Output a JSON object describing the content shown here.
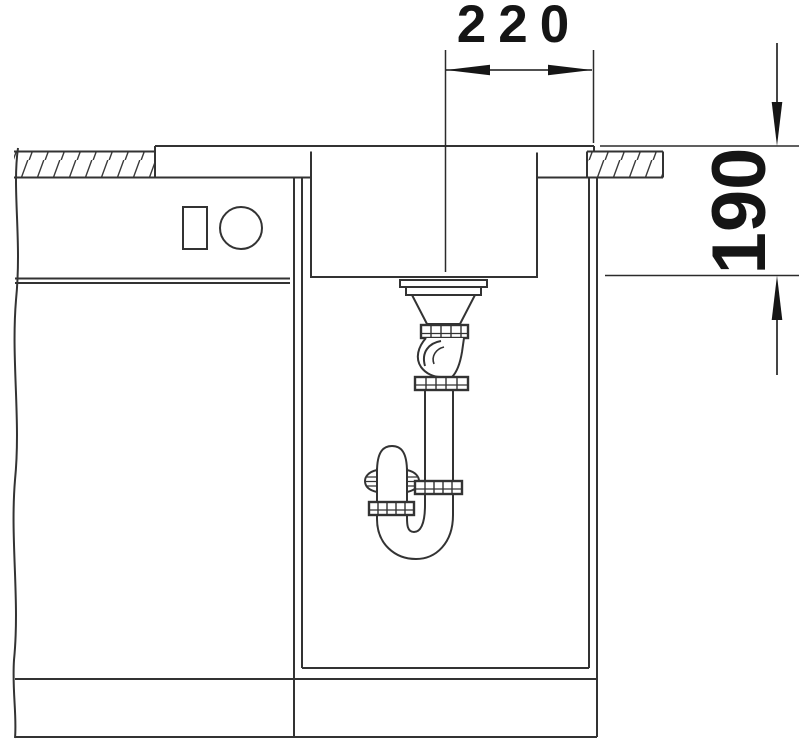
{
  "drawing": {
    "title": "Sink installation cross-section drawing",
    "dimensions": {
      "drain_to_edge": {
        "label": "220"
      },
      "installation_depth": {
        "label": "190"
      }
    },
    "colors": {
      "background": "#ffffff",
      "line": "#333333",
      "dimension": "#151515"
    }
  }
}
